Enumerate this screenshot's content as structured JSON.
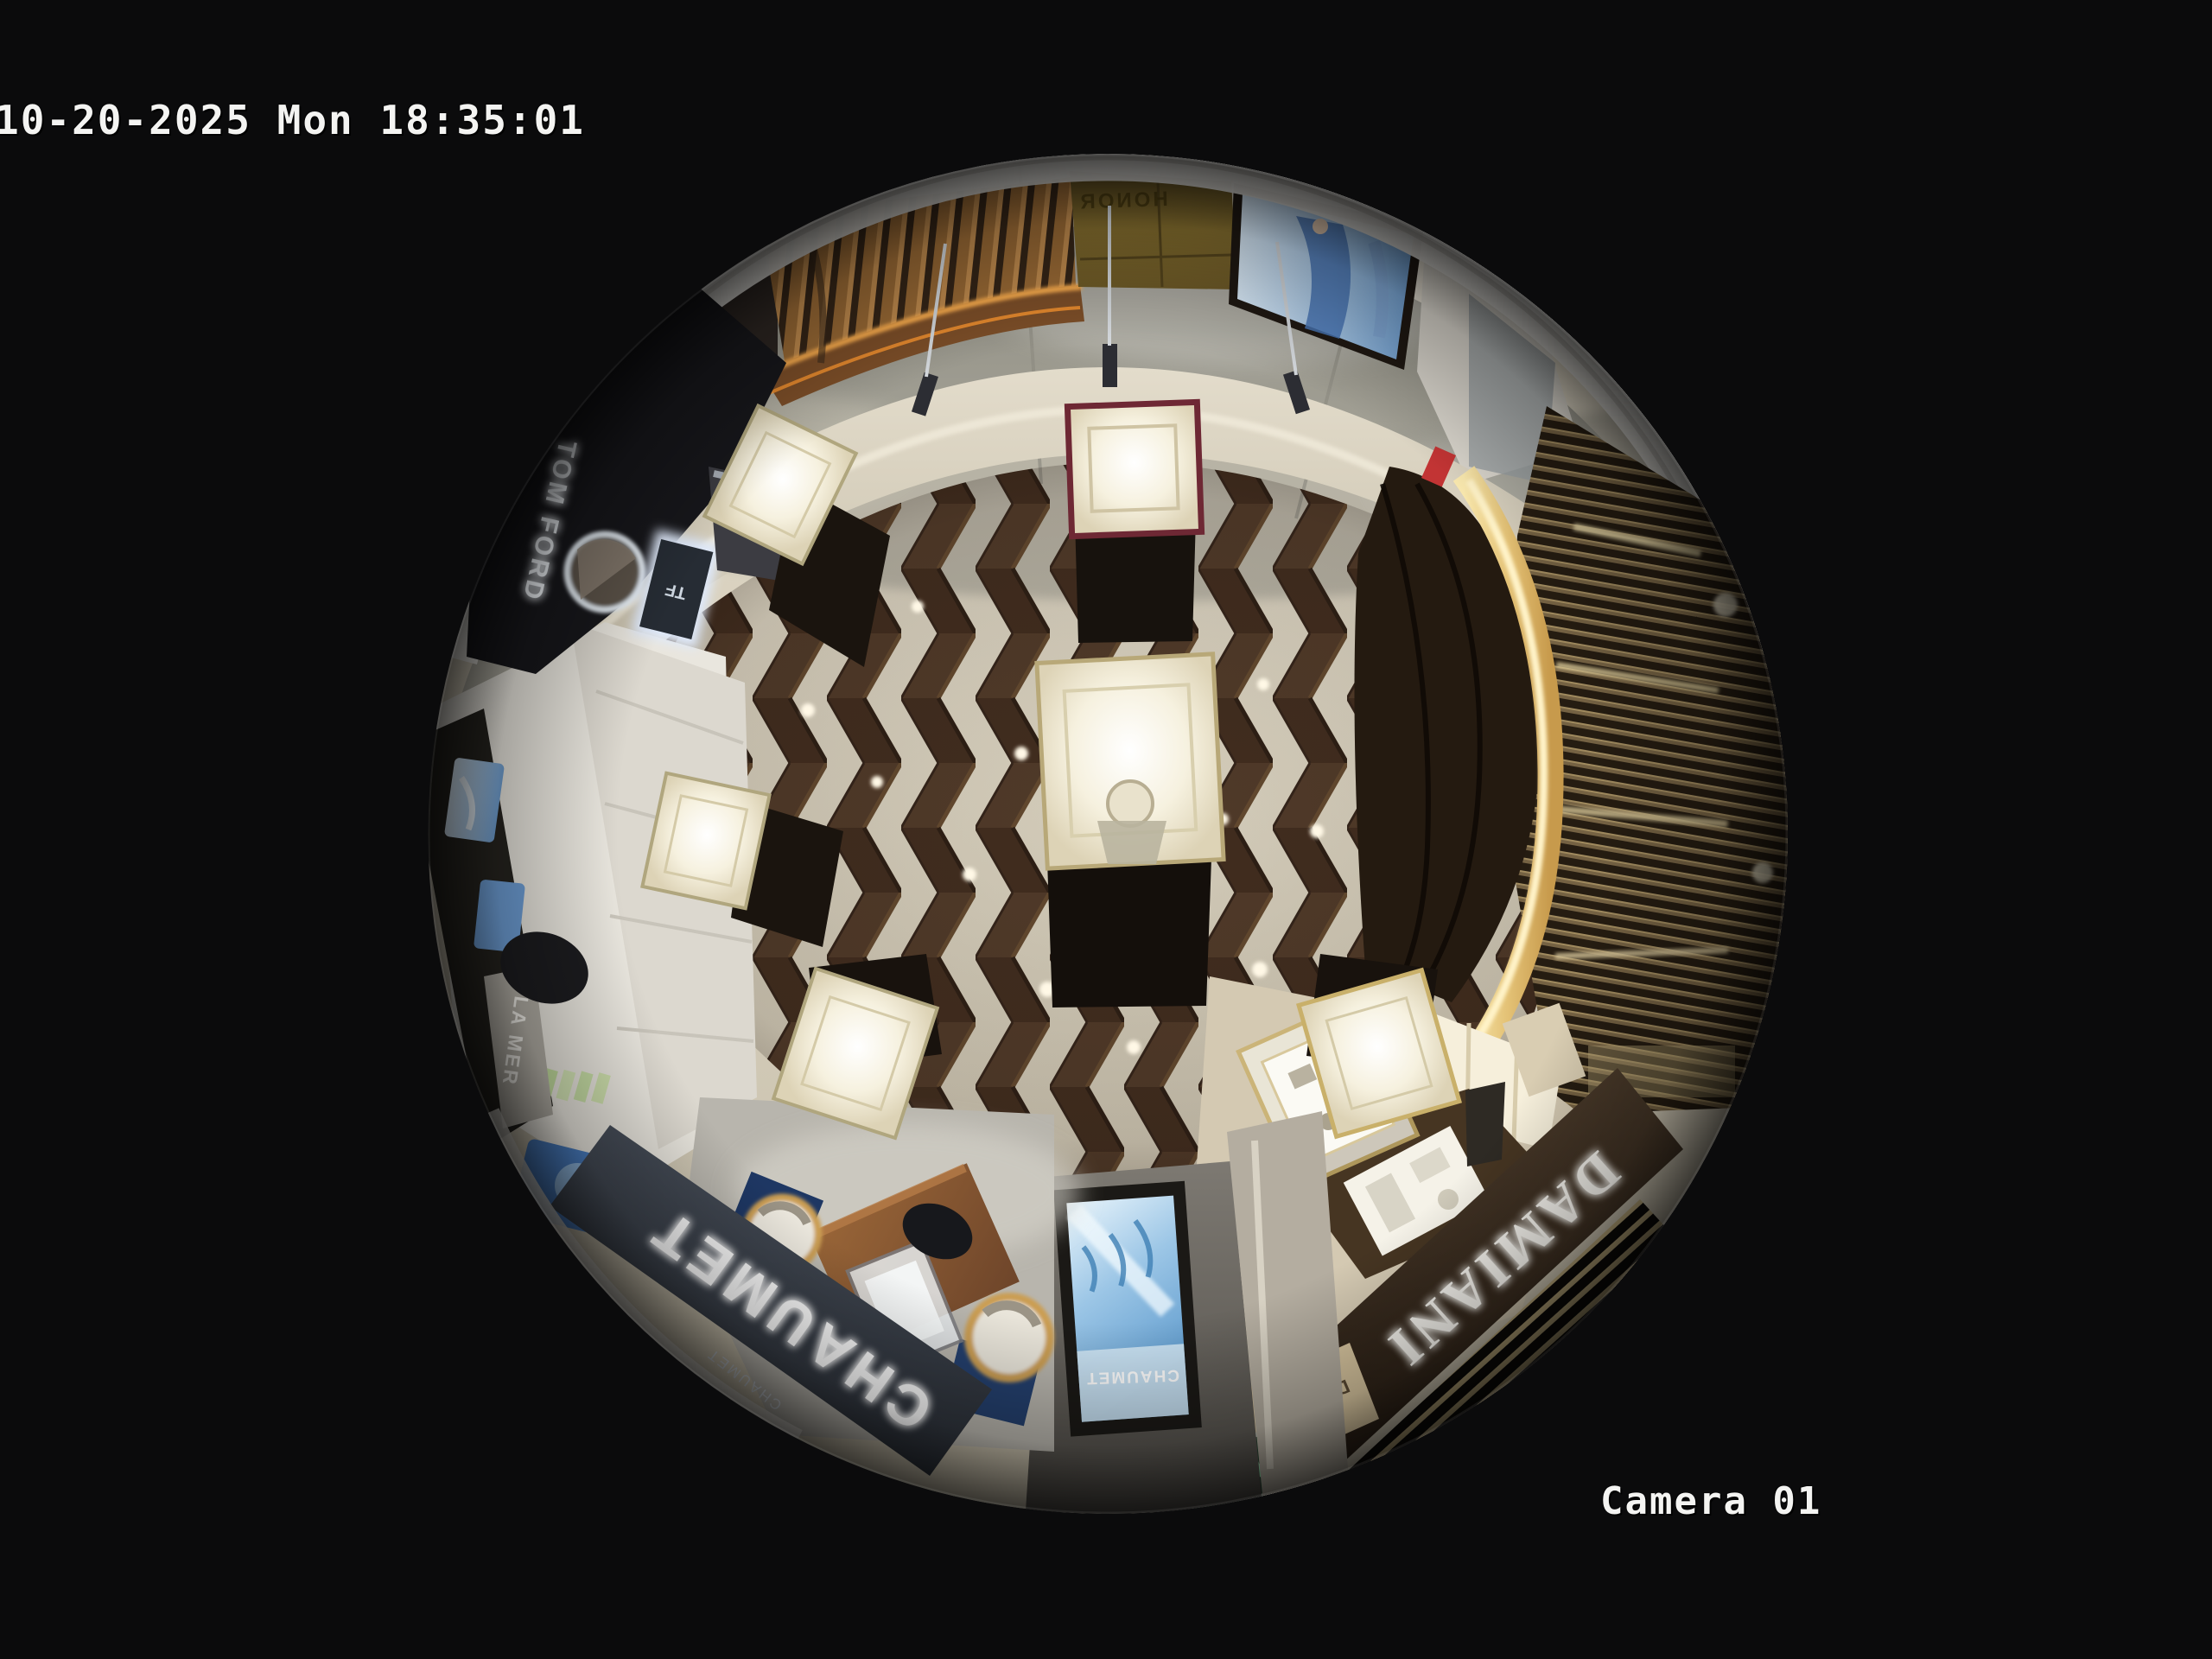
{
  "osd": {
    "timestamp": "10-20-2025 Mon 18:35:01",
    "camera_label": "Camera 01"
  },
  "signs": {
    "chaumet_fascia": "CHAUMET",
    "chaumet_fascia_small": "CHAUMET",
    "chaumet_screen": "CHAUMET",
    "damiani_fascia": "DAMIANI",
    "damiani_board": "DAMIANI",
    "tom_ford": "TOM FORD",
    "tf_logo": "TF",
    "la_mer_pillar": "LA MER",
    "exit_sign": "安全出口 EXIT",
    "gold_wall": "HONOR"
  },
  "colors": {
    "background": "#0b0b0c",
    "osd_text": "#f4f4f2",
    "wood_floor": "#4e3627",
    "stone_floor": "#d6cfbe",
    "mall_marble": "#a9a79c",
    "chaumet_fascia_band": "#3a4049",
    "damiani_fascia_band": "#3b2d20",
    "gold_lit_band": "#eed290",
    "screen_blue": "#7db8e0",
    "exit_green": "#2c5a40",
    "led_warm": "#ffb050"
  }
}
